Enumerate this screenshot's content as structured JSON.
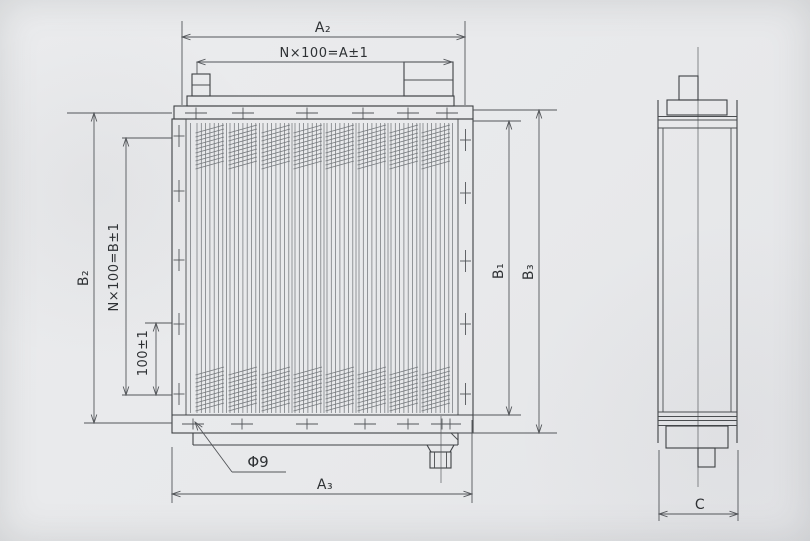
{
  "drawing": {
    "type": "engineering-dimension-drawing",
    "front_view": {
      "dim_top_overall": "A₂",
      "dim_top_pitch_formula": "N×100=A±1",
      "dim_left_overall": "B₂",
      "dim_left_pitch_formula": "N×100=B±1",
      "dim_left_single_pitch": "100±1",
      "dim_right_inner": "B₁",
      "dim_right_overall": "B₃",
      "dim_bottom_overall": "A₃",
      "hole_callout": "Φ9"
    },
    "side_view": {
      "dim_width": "C"
    },
    "colors": {
      "paper": "#e9eaec",
      "line": "#3e4144",
      "dim_line": "#53565a",
      "text": "#2e3134"
    }
  }
}
